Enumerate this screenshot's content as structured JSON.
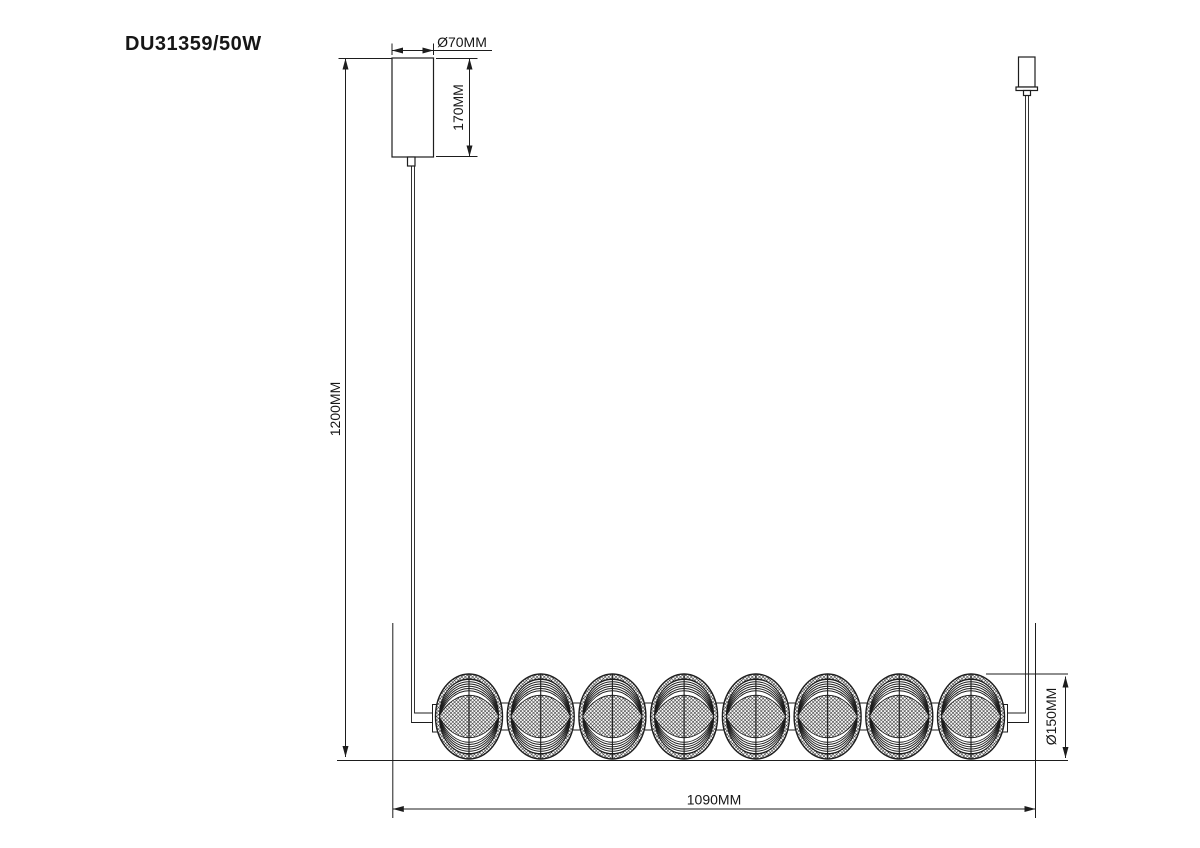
{
  "drawing": {
    "product_code": "DU31359/50W",
    "labels": {
      "canopy_diameter": "Ø70MM",
      "canopy_height": "170MM",
      "suspension_drop": "1200MM",
      "fixture_length": "1090MM",
      "ball_diameter": "Ø150MM"
    },
    "fixture": {
      "ball_count": 8,
      "first_ball_cx": 469,
      "last_ball_cx": 971,
      "ball_cy": 716.5,
      "ball_rx": 33.5,
      "ball_ry": 42.5
    },
    "colors": {
      "line": "#1d1d1d",
      "text": "#161616",
      "background": "#ffffff"
    }
  }
}
